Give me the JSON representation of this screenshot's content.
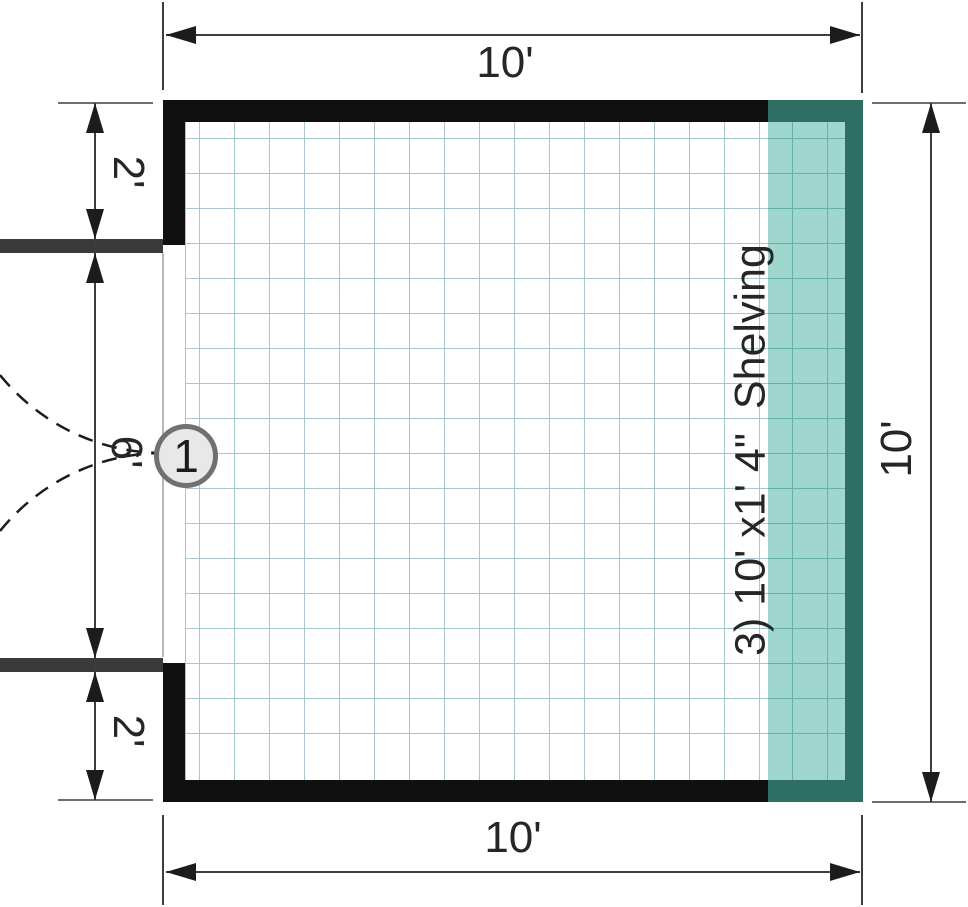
{
  "floorplan": {
    "dimensions": {
      "top": "10'",
      "bottom": "10'",
      "right": "10'",
      "left_top": "2'",
      "left_middle": "6'",
      "left_bottom": "2'"
    },
    "shelving_note": "3) 10' x1' 4\"  Shelving",
    "door_marker": "1"
  },
  "colors": {
    "wall": "#101010",
    "door_jamb_wall": "#3a3a3a",
    "shelf_outline": "#2e6e63",
    "shelf_fill": "#9fd7ce",
    "shelf_grid_line": "#67b0a7",
    "floor_grid_line": "#a6c8cc",
    "dimension_line": "#3d3d3d",
    "arrow": "#1c1c1c",
    "door_swing_dash": "#1c1c1c",
    "threshold_line": "#b8b8b8",
    "text": "#262626",
    "marker_fill": "#e8e8e8",
    "marker_border": "#707070"
  }
}
